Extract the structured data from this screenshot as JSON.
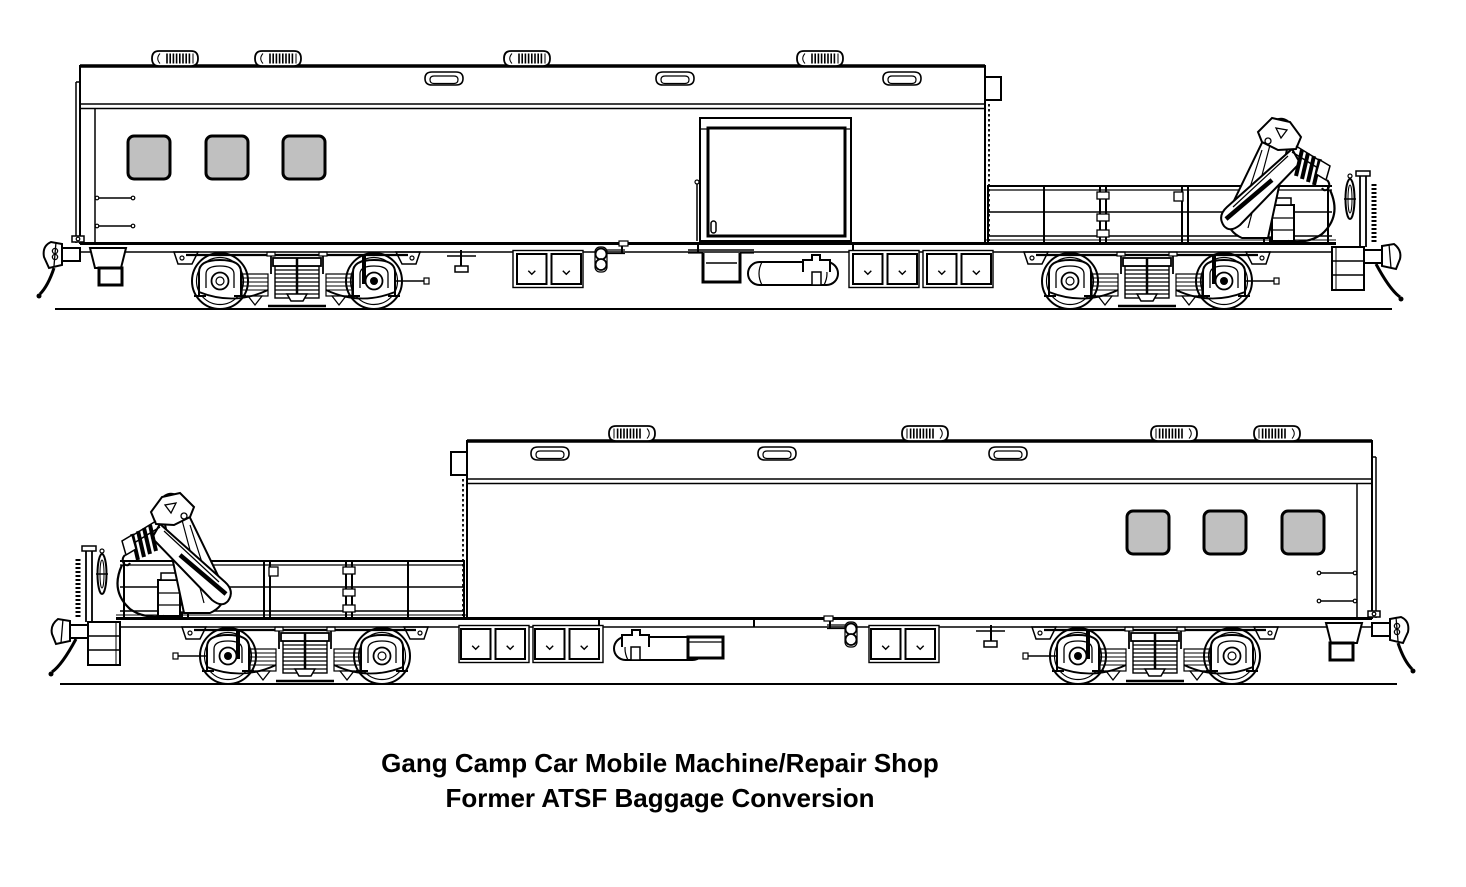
{
  "caption": {
    "line1": "Gang Camp Car Mobile Machine/Repair Shop",
    "line2": "Former ATSF Baggage Conversion"
  },
  "colors": {
    "line": "#000000",
    "window_fill": "#c0c0c0",
    "background": "#ffffff"
  }
}
